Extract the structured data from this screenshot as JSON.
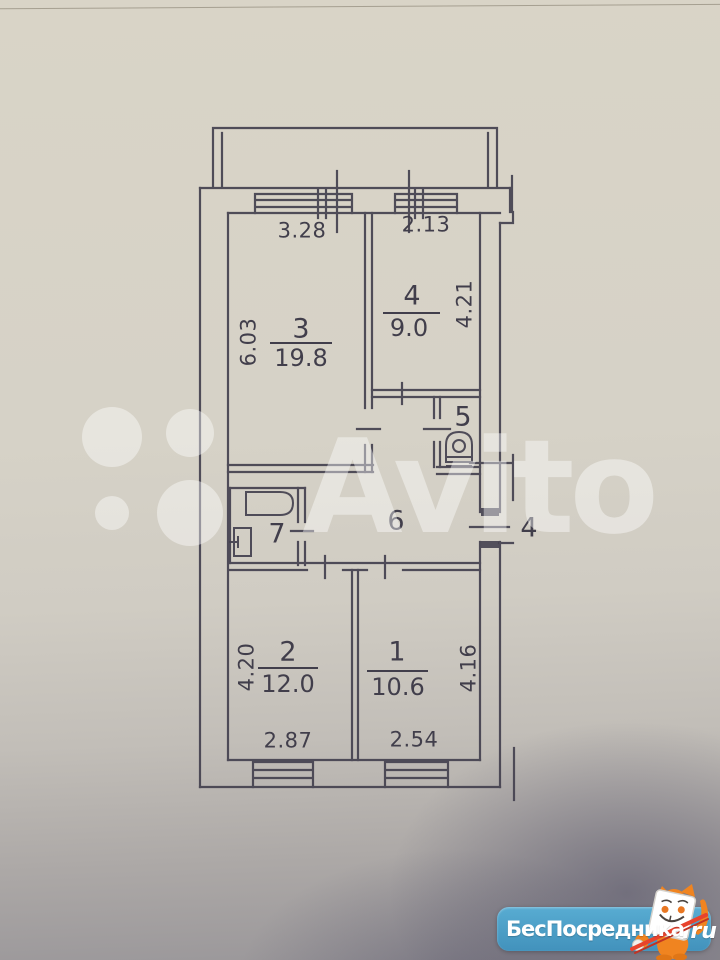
{
  "colors": {
    "ink": "#454250",
    "paper_top": "#d9d4c7",
    "shadow_gray": "#999699",
    "logo_blue": "#4b9fc6",
    "mascot_orange": "#f08420",
    "pencil_red": "#e8432d",
    "watermark_white": "rgba(255,255,255,0.42)"
  },
  "watermark": {
    "brand": "Avito"
  },
  "logo": {
    "text": "БесПосредника",
    "suffix": ".ru"
  },
  "plan": {
    "rooms": {
      "r1": {
        "number": "1",
        "area": "10.6"
      },
      "r2": {
        "number": "2",
        "area": "12.0"
      },
      "r3": {
        "number": "3",
        "area": "19.8"
      },
      "r4": {
        "number": "4",
        "area": "9.0"
      },
      "r5": {
        "number": "5"
      },
      "r6": {
        "number": "6"
      },
      "r7": {
        "number": "7"
      },
      "entry": {
        "number": "4"
      }
    },
    "dims": {
      "room3_width": "3.28",
      "room3_height": "6.03",
      "room4_width": "2.13",
      "room4_height": "4.21",
      "room2_width": "2.87",
      "room2_height": "4.20",
      "room1_width": "2.54",
      "room1_height": "4.16"
    }
  }
}
